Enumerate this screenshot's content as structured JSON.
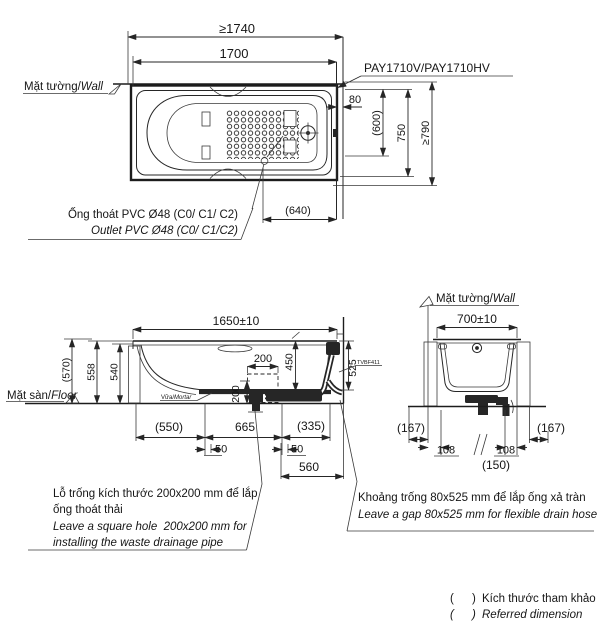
{
  "colors": {
    "ink": "#262626",
    "bg": "#ffffff"
  },
  "plan": {
    "model": "PAY1710V/PAY1710HV",
    "wall_vi": "Mặt tường/",
    "wall_en": "Wall",
    "dims": {
      "total_len": "≥1740",
      "len": "1700",
      "gap80": "80",
      "inner_w": "(600)",
      "w": "750",
      "total_w": "≥790",
      "outlet_x": "(640)"
    },
    "outlet_vi": "Ống thoát PVC Ø48 (C0/ C1/ C2)",
    "outlet_en": "Outlet PVC Ø48 (C0/ C1/C2)"
  },
  "side": {
    "dims": {
      "len": "1650±10",
      "h_total": "(570)",
      "h_rim": "558",
      "h_inner": "540",
      "hole_w": "200",
      "depth": "450",
      "hole_h": "200",
      "gap_h": "525",
      "d550": "(550)",
      "d665": "665",
      "d335": "(335)",
      "d50a": "50",
      "d50b": "50",
      "d560": "560"
    },
    "floor_vi": "Mặt sàn/",
    "floor_en": "Floor",
    "mortar_vi": "Vữa/",
    "mortar_en": "Mortar",
    "valve": "TVBF411"
  },
  "endview": {
    "wall_vi": "Mặt tường/",
    "wall_en": "Wall",
    "dims": {
      "w": "700±10",
      "d167l": "(167)",
      "d167r": "(167)",
      "d108l": "108",
      "d108r": "108",
      "d150": "(150)"
    }
  },
  "notes": {
    "hole_vi1": "Lỗ trống kích thước 200x200 mm để lắp",
    "hole_vi2": "ống thoát thải",
    "hole_en1": "Leave a square hole  200x200 mm for",
    "hole_en2": "installing the waste drainage pipe",
    "gap_vi": "Khoảng trống 80x525 mm để lắp ống xả tràn",
    "gap_en": "Leave a gap 80x525 mm for flexible drain hose"
  },
  "legend": {
    "open": "(",
    "close": ")",
    "vi": "Kích thước tham khảo",
    "en": "Referred dimension"
  }
}
